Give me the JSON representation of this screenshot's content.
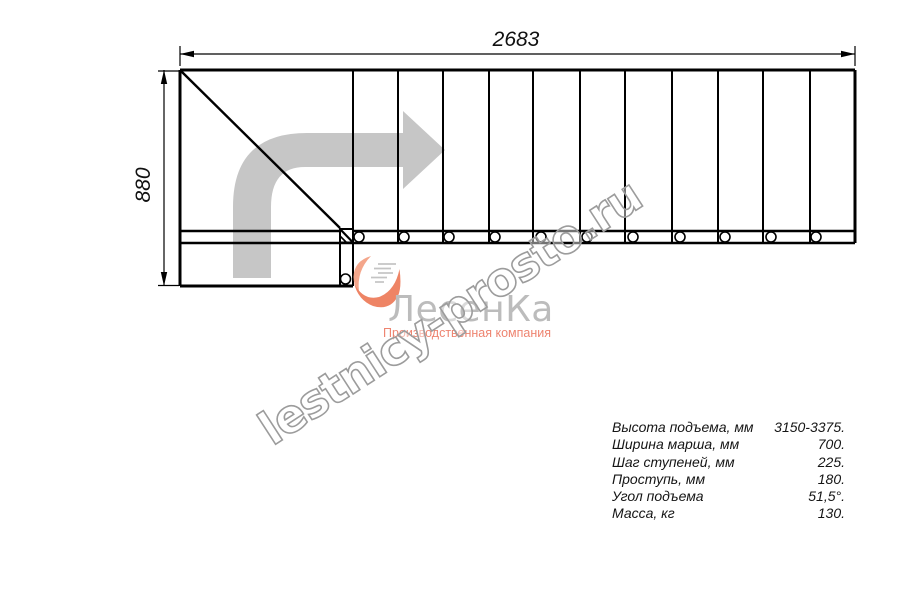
{
  "drawing_title": "stair-plan-view",
  "dimensions": {
    "width_mm": "2683",
    "depth_mm": "880"
  },
  "watermark": {
    "text": "lestnicy-prosto.ru"
  },
  "logo": {
    "title": "ЛесенКа",
    "subtitle": "Производственная компания",
    "heart_icon": "heart-stairs-swoosh"
  },
  "specs": {
    "rows": [
      {
        "label": "Высота подъема, мм",
        "value": "3150-3375."
      },
      {
        "label": "Ширина марша, мм",
        "value": "700."
      },
      {
        "label": "Шаг ступеней, мм",
        "value": "225."
      },
      {
        "label": "Проступь, мм",
        "value": "180."
      },
      {
        "label": "Угол подъема",
        "value": "51,5°."
      },
      {
        "label": "Масса, кг",
        "value": "130."
      }
    ]
  },
  "colors": {
    "line": "#000000",
    "direction_arrow": "#c6c6c6",
    "watermark_outline": "#9c9c9c",
    "logo_gray": "#bcbcbc",
    "logo_salmon": "#ee8470"
  }
}
